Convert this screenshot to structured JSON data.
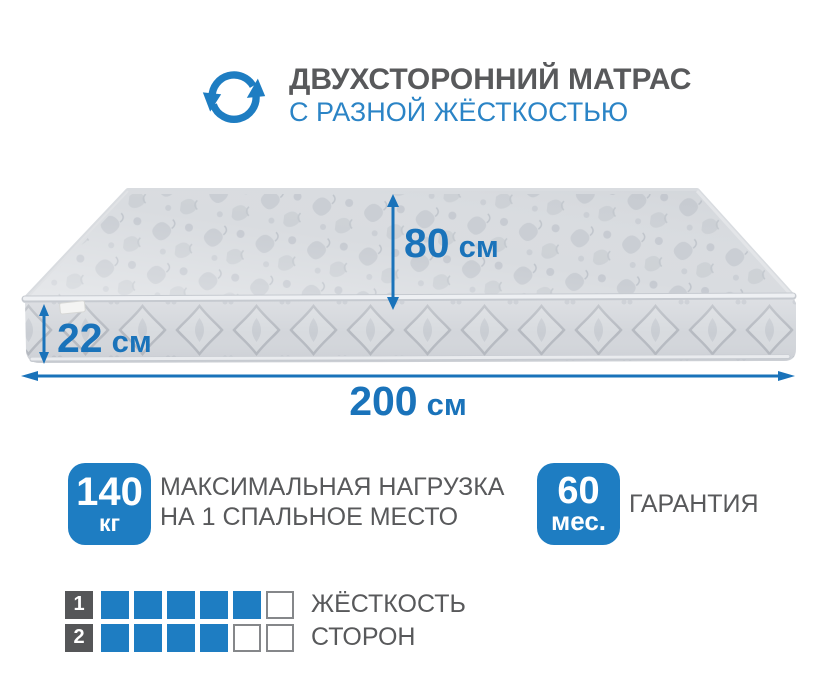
{
  "colors": {
    "accent_blue": "#1e7dc2",
    "dim_blue": "#1a73ba",
    "subtitle_blue": "#2b84c6",
    "text_gray": "#58595b",
    "square_gray": "#555658",
    "cell_border": "#85878a"
  },
  "header": {
    "icon": "rotate-arrows-icon",
    "title": "ДВУХСТОРОННИЙ МАТРАС",
    "subtitle": "С РАЗНОЙ ЖЁСТКОСТЬЮ"
  },
  "dimensions": {
    "height_of_sleeping_place": {
      "value": "80",
      "unit": "см"
    },
    "thickness": {
      "value": "22",
      "unit": "см"
    },
    "length": {
      "value": "200",
      "unit": "см"
    }
  },
  "badges": [
    {
      "value": "140",
      "unit": "кг",
      "label_lines": [
        "МАКСИМАЛЬНАЯ НАГРУЗКА",
        "НА 1 СПАЛЬНОЕ МЕСТО"
      ]
    },
    {
      "value": "60",
      "unit": "мес.",
      "label_lines": [
        "ГАРАНТИЯ"
      ]
    }
  ],
  "firmness": {
    "rows": [
      {
        "number": "1",
        "filled": 5,
        "total": 6,
        "label": "ЖЁСТКОСТЬ"
      },
      {
        "number": "2",
        "filled": 4,
        "total": 6,
        "label": "СТОРОН"
      }
    ]
  }
}
